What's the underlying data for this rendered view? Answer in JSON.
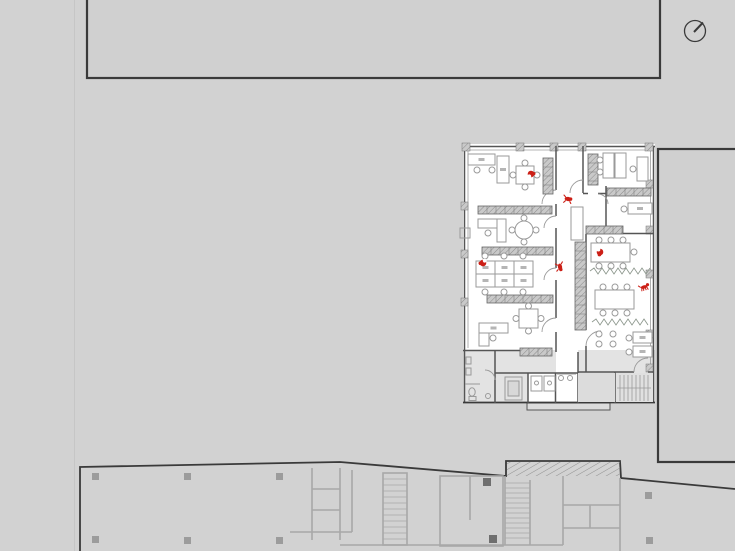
{
  "scene": {
    "description": "Architectural office floor plan (white) placed over a gray site with adjacent building outlines, a lower-floor structural plan at the bottom, red occupant figures and a north indicator circle at top right",
    "has_text": false
  },
  "colors": {
    "background": "#d2d2d2",
    "building_fill": "#d0d0d0",
    "dark_outline": "#3a3a3a",
    "plan_wall": "#555555",
    "window_line": "#9b9b9b",
    "furniture": "#9a9a9a",
    "hatch_fill": "#c9c9c9",
    "hatch_line": "#8c8c8c",
    "gray_wall": "#a8a8a8",
    "service_fill": "#e3e3e3",
    "column": "#9c9c9c",
    "faint_line": "#c6c6c6",
    "plant": "#8e988e",
    "red": "#cc1f16"
  },
  "north_indicator": {
    "cx": 695,
    "cy": 31,
    "r": 10.5,
    "needle": [
      [
        694,
        32
      ],
      [
        703,
        22.5
      ]
    ]
  },
  "occupants": {
    "figures": [
      {
        "type": "person-seated",
        "label": "person at square table, top-left office",
        "x": 531,
        "y": 174,
        "rot": -20
      },
      {
        "type": "person-walking",
        "label": "person in upper corridor",
        "x": 568,
        "y": 199,
        "rot": 10
      },
      {
        "type": "person-seated",
        "label": "person at bench desk, left office",
        "x": 483,
        "y": 263,
        "rot": 160
      },
      {
        "type": "person-walking",
        "label": "person in main corridor",
        "x": 560,
        "y": 267,
        "rot": 80
      },
      {
        "type": "person-seated",
        "label": "person at conference table",
        "x": 600,
        "y": 252,
        "rot": 90
      },
      {
        "type": "dog",
        "label": "dog near right wall",
        "x": 644,
        "y": 287,
        "rot": -15
      }
    ]
  },
  "furniture": {
    "shelves": [
      {
        "x": 543,
        "y": 158,
        "w": 10,
        "h": 36
      },
      {
        "x": 478,
        "y": 206,
        "w": 74,
        "h": 8
      },
      {
        "x": 482,
        "y": 247,
        "w": 71,
        "h": 8
      },
      {
        "x": 487,
        "y": 295,
        "w": 66,
        "h": 8
      },
      {
        "x": 520,
        "y": 348,
        "w": 32,
        "h": 8
      },
      {
        "x": 588,
        "y": 154,
        "w": 10,
        "h": 31
      },
      {
        "x": 607,
        "y": 188,
        "w": 44,
        "h": 8
      },
      {
        "x": 586,
        "y": 226,
        "w": 37,
        "h": 8
      },
      {
        "x": 575,
        "y": 242,
        "w": 11,
        "h": 88
      }
    ],
    "desks": [
      {
        "x": 468,
        "y": 154,
        "w": 27,
        "h": 11,
        "chairs": [
          [
            477,
            170
          ]
        ]
      },
      {
        "x": 497,
        "y": 156,
        "w": 12,
        "h": 27,
        "chairs": [
          [
            492,
            170
          ]
        ]
      },
      {
        "x": 478,
        "y": 219,
        "w": 28,
        "h": 9,
        "chairs": [
          [
            488,
            233
          ]
        ]
      },
      {
        "x": 497,
        "y": 219,
        "w": 9,
        "h": 23,
        "chairs": []
      },
      {
        "x": 476,
        "y": 261,
        "w": 19,
        "h": 13,
        "chairs": [
          [
            485,
            256
          ]
        ]
      },
      {
        "x": 495,
        "y": 261,
        "w": 19,
        "h": 13,
        "chairs": [
          [
            504,
            256
          ]
        ]
      },
      {
        "x": 514,
        "y": 261,
        "w": 19,
        "h": 13,
        "chairs": [
          [
            523,
            256
          ]
        ]
      },
      {
        "x": 476,
        "y": 274,
        "w": 19,
        "h": 13,
        "chairs": [
          [
            485,
            292
          ]
        ]
      },
      {
        "x": 495,
        "y": 274,
        "w": 19,
        "h": 13,
        "chairs": [
          [
            504,
            292
          ]
        ]
      },
      {
        "x": 514,
        "y": 274,
        "w": 19,
        "h": 13,
        "chairs": [
          [
            523,
            292
          ]
        ]
      },
      {
        "x": 479,
        "y": 323,
        "w": 29,
        "h": 10,
        "chairs": [
          [
            493,
            338
          ]
        ]
      },
      {
        "x": 479,
        "y": 333,
        "w": 10,
        "h": 13,
        "chairs": []
      },
      {
        "x": 603,
        "y": 153,
        "w": 11,
        "h": 25,
        "chairs": [
          [
            600,
            160
          ]
        ]
      },
      {
        "x": 615,
        "y": 153,
        "w": 11,
        "h": 25,
        "chairs": [
          [
            600,
            172
          ]
        ]
      },
      {
        "x": 637,
        "y": 157,
        "w": 11,
        "h": 24,
        "chairs": [
          [
            633,
            169
          ]
        ]
      },
      {
        "x": 628,
        "y": 203,
        "w": 24,
        "h": 11,
        "chairs": [
          [
            624,
            209
          ]
        ]
      },
      {
        "x": 633,
        "y": 332,
        "w": 19,
        "h": 11,
        "chairs": [
          [
            629,
            338
          ]
        ]
      },
      {
        "x": 633,
        "y": 346,
        "w": 19,
        "h": 11,
        "chairs": [
          [
            629,
            352
          ]
        ]
      }
    ],
    "square_tables": [
      {
        "x": 516,
        "y": 166,
        "size": 18
      },
      {
        "x": 519,
        "y": 309,
        "size": 19
      }
    ],
    "round_tables": [
      {
        "cx": 524,
        "cy": 230,
        "r": 9
      }
    ],
    "conference_tables": [
      {
        "x": 591,
        "y": 243,
        "w": 39,
        "h": 19,
        "chairs": [
          [
            599,
            240
          ],
          [
            611,
            240
          ],
          [
            623,
            240
          ],
          [
            599,
            266
          ],
          [
            611,
            266
          ],
          [
            623,
            266
          ],
          [
            634,
            252
          ]
        ]
      },
      {
        "x": 595,
        "y": 290,
        "w": 39,
        "h": 19,
        "chairs": [
          [
            603,
            287
          ],
          [
            615,
            287
          ],
          [
            627,
            287
          ],
          [
            603,
            313
          ],
          [
            615,
            313
          ],
          [
            627,
            313
          ]
        ]
      }
    ],
    "lounge_groups": [
      {
        "cx": 606,
        "cy": 339
      }
    ],
    "plant_rows": [
      {
        "x1": 590,
        "y": 271,
        "x2": 652
      },
      {
        "x1": 592,
        "y": 322,
        "x2": 650
      }
    ]
  },
  "structure": {
    "columns": [
      [
        92,
        473
      ],
      [
        184,
        473
      ],
      [
        276,
        473
      ],
      [
        92,
        536
      ],
      [
        184,
        537
      ],
      [
        276,
        537
      ],
      [
        645,
        492
      ],
      [
        646,
        537
      ]
    ],
    "column_size": 7,
    "buildings": {
      "top": {
        "x": 87,
        "y": -6,
        "w": 573,
        "h": 84
      },
      "right": {
        "x": 658,
        "y": 149,
        "w": 82,
        "h": 313
      }
    }
  }
}
